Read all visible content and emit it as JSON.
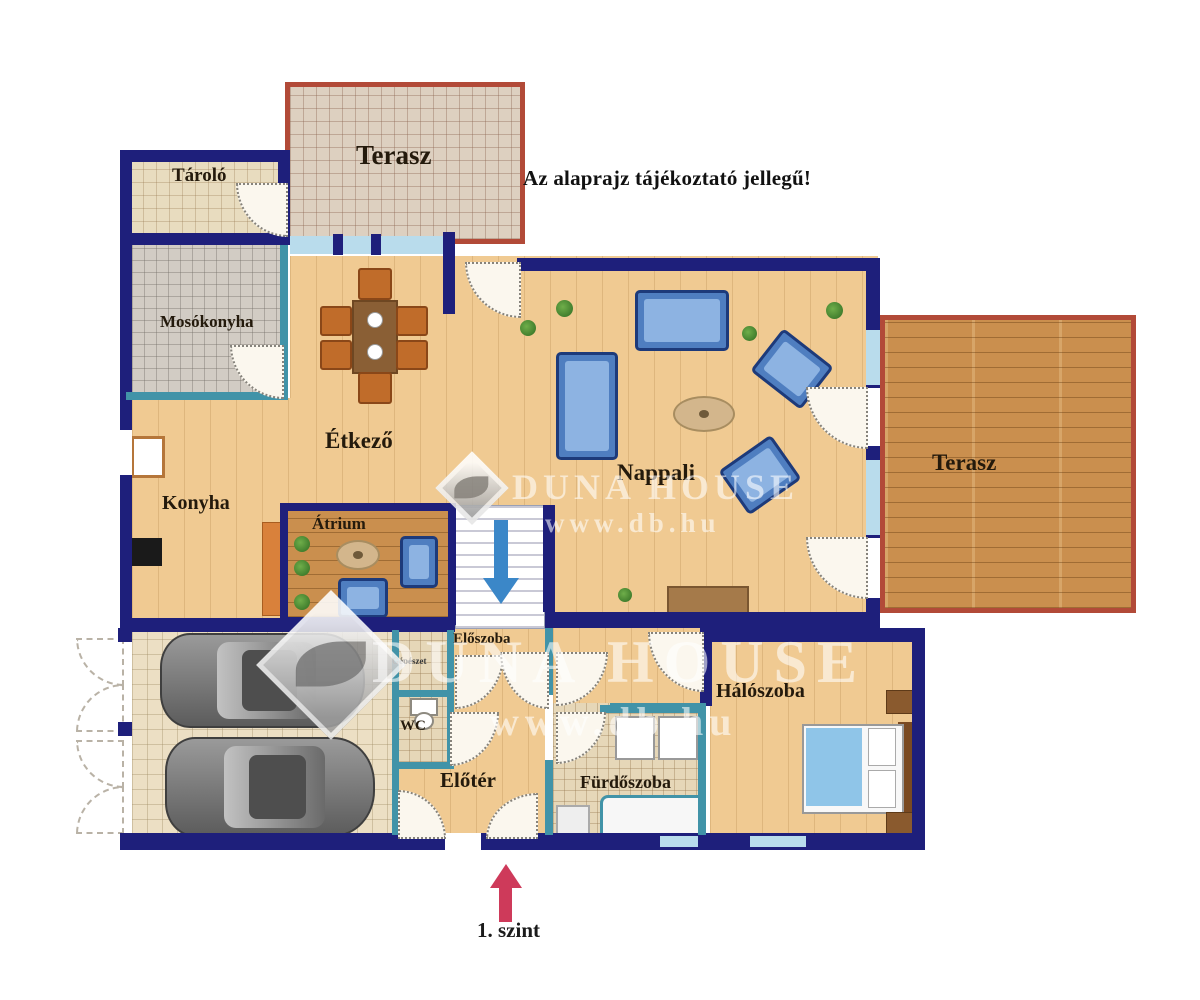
{
  "note": "Az alaprajz tájékoztató jellegű!",
  "level": "1. szint",
  "watermark": {
    "brand": "DUNA HOUSE",
    "site": "www.db.hu"
  },
  "rooms": {
    "terrace_top": "Terasz",
    "storage": "Tároló",
    "laundry": "Mosókonyha",
    "kitchen": "Konyha",
    "dining": "Étkező",
    "atrium": "Átrium",
    "living": "Nappali",
    "terrace_right": "Terasz",
    "hallway": "Előszoba",
    "mechanical": "Gépészet",
    "wc": "WC",
    "foyer": "Előtér",
    "bathroom": "Fürdőszoba",
    "bedroom": "Hálószoba"
  },
  "colors": {
    "exterior_wall": "#1e1f7b",
    "interior_wall": "#4193a8",
    "glass": "#b9dcec",
    "terrace_border": "#b24a38",
    "wood_floor": "#f0ca92",
    "deck_wood": "#ca8f4e",
    "level_arrow": "#ce3a5a",
    "stairs_arrow": "#3b87c8"
  }
}
